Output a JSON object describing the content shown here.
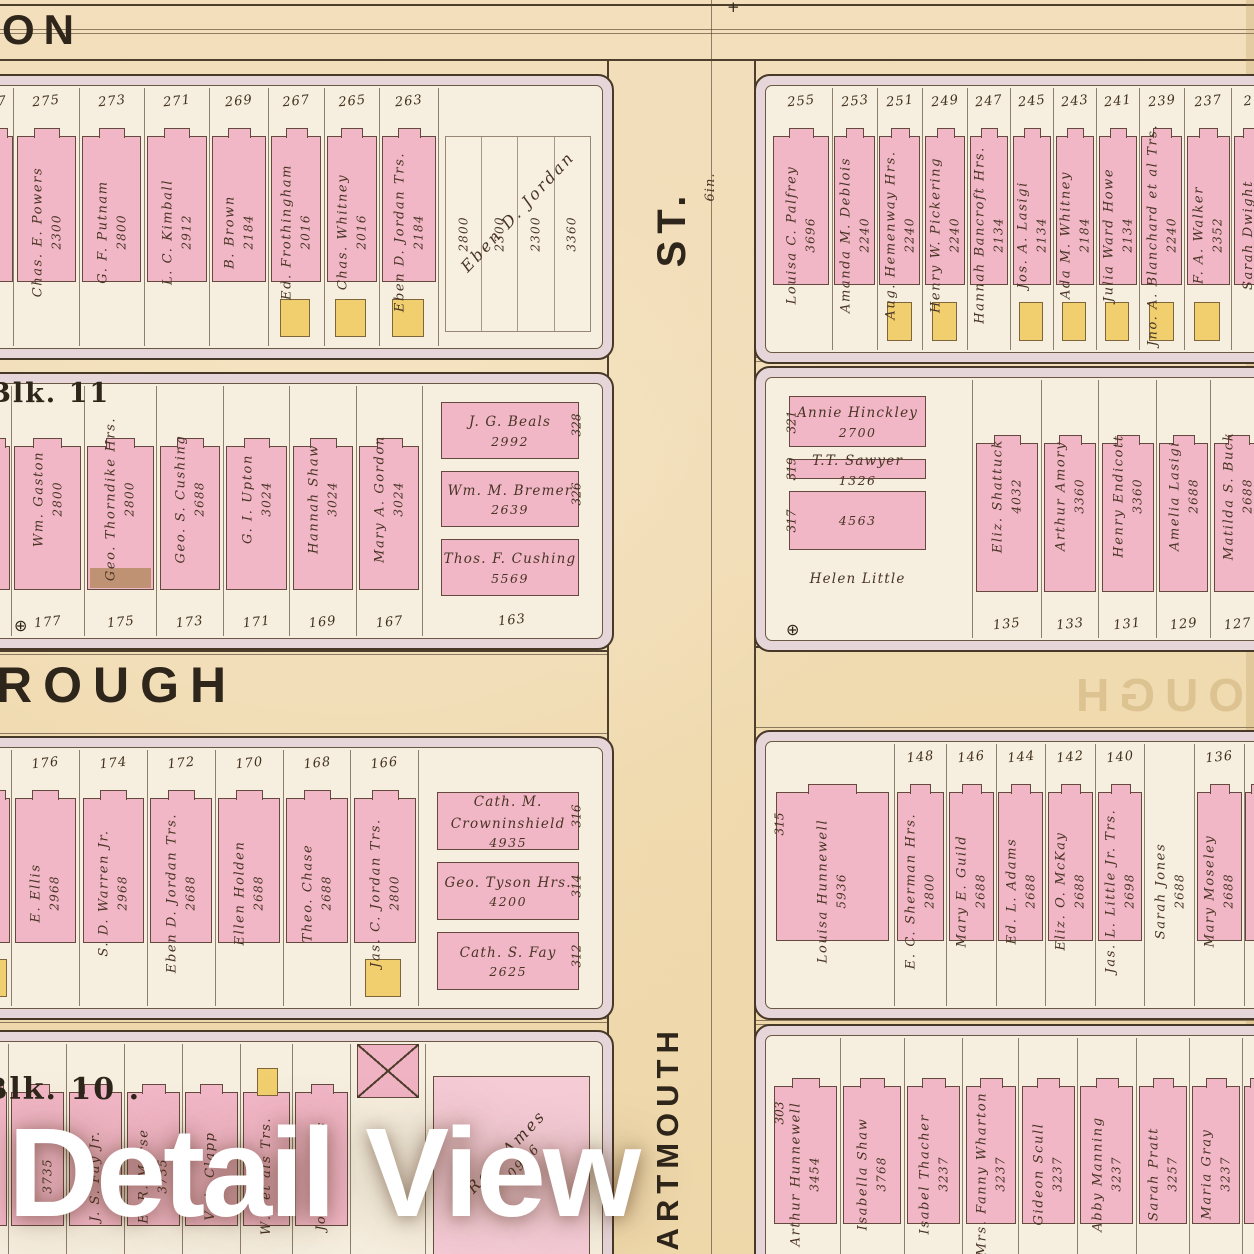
{
  "watermark": "Detail View",
  "labels": {
    "top_street": "ON",
    "cross_street_top": "ST.",
    "pipe_note": "6in.",
    "mid_street": "ROUGH",
    "mid_street_ghost": "ROUGH",
    "cross_street_bottom": "DARTMOUTH",
    "blk11": "Blk. 11",
    "blk10": "Blk. 10 .",
    "benchmark_symbol": "⊕",
    "survey_mark": "+"
  },
  "colors": {
    "paper": "#f3dfbc",
    "block_band": "#e6d6d9",
    "block_interior": "#f6eede",
    "building_pink": "#f2b7c6",
    "building_pale_pink": "#f5ccd6",
    "wood_yellow": "#f1cf6e",
    "stable_brown": "#b98e6a",
    "line_ink": "#4e3e2c",
    "text_ink": "#4a3728"
  },
  "blocks": {
    "row1_left": {
      "street": "top",
      "lots": [
        {
          "no": "7",
          "w": 0.35,
          "fill": "pink",
          "cut": true
        },
        {
          "no": "275",
          "name": "Chas. E. Powers",
          "area": "2300",
          "fill": "pink",
          "w": 1
        },
        {
          "no": "273",
          "name": "G. F. Putnam",
          "area": "2800",
          "fill": "pink",
          "w": 1
        },
        {
          "no": "271",
          "name": "L. C. Kimball",
          "area": "2912",
          "fill": "pink",
          "w": 1
        },
        {
          "no": "269",
          "name": "B. Brown",
          "area": "2184",
          "fill": "pink",
          "w": 0.9
        },
        {
          "no": "267",
          "name": "Ed. Frothingham",
          "area": "2016",
          "fill": "pink",
          "w": 0.85,
          "rear": "yellow"
        },
        {
          "no": "265",
          "name": "Chas. Whitney",
          "area": "2016",
          "fill": "pink",
          "w": 0.85,
          "rear": "yellow"
        },
        {
          "no": "263",
          "name": "Eben D. Jordan Trs.",
          "area": "2184",
          "fill": "pink",
          "w": 0.9,
          "rear": "yellow"
        }
      ],
      "corner": {
        "type": "diagonal",
        "name": "Eben D. Jordan",
        "values": [
          "2800",
          "2300",
          "2300",
          "3360"
        ],
        "w": 2.4
      }
    },
    "row1_right": {
      "street": "top",
      "lots": [
        {
          "no": "255",
          "name": "Louisa C. Palfrey",
          "area": "3696",
          "fill": "pink",
          "w": 1.3
        },
        {
          "no": "253",
          "name": "Amanda M. Deblois",
          "area": "2240",
          "fill": "pink",
          "w": 0.95
        },
        {
          "no": "251",
          "name": "Aug. Hemenway Hrs.",
          "area": "2240",
          "fill": "pink",
          "w": 0.95,
          "rear": "yellow"
        },
        {
          "no": "249",
          "name": "Henry W. Pickering",
          "area": "2240",
          "fill": "pink",
          "w": 0.95,
          "rear": "yellow"
        },
        {
          "no": "247",
          "name": "Hannah Bancroft Hrs.",
          "area": "2134",
          "fill": "pink",
          "w": 0.9
        },
        {
          "no": "245",
          "name": "Jos. A. Lasigi",
          "area": "2134",
          "fill": "pink",
          "w": 0.9,
          "rear": "yellow"
        },
        {
          "no": "243",
          "name": "Ada M. Whitney",
          "area": "2184",
          "fill": "pink",
          "w": 0.9,
          "rear": "yellow"
        },
        {
          "no": "241",
          "name": "Julia Ward Howe",
          "area": "2134",
          "fill": "pink",
          "w": 0.9,
          "rear": "yellow"
        },
        {
          "no": "239",
          "name": "Jno. A. Blanchard et al Trs.",
          "area": "2240",
          "fill": "pink",
          "w": 0.95,
          "rear": "yellow"
        },
        {
          "no": "237",
          "name": "F. A. Walker",
          "area": "2352",
          "fill": "pink",
          "w": 1,
          "rear": "yellow"
        },
        {
          "no": "2",
          "name": "Sarah Dwight",
          "fill": "pink",
          "w": 0.7,
          "cut": true
        }
      ]
    },
    "row2_left": {
      "street": "bottom",
      "lots": [
        {
          "w": 0.3,
          "fill": "pink",
          "cut": true
        },
        {
          "no": "177",
          "name": "Wm. Gaston",
          "area": "2800",
          "fill": "pink",
          "w": 1.1
        },
        {
          "no": "175",
          "name": "Geo. Thorndike Hrs.",
          "area": "2800",
          "fill": "pink",
          "w": 1.1,
          "rear": "brown"
        },
        {
          "no": "173",
          "name": "Geo. S. Cushing",
          "area": "2688",
          "fill": "pink",
          "w": 1
        },
        {
          "no": "171",
          "name": "G. I. Upton",
          "area": "3024",
          "fill": "pink",
          "w": 1
        },
        {
          "no": "169",
          "name": "Hannah Shaw",
          "area": "3024",
          "fill": "pink",
          "w": 1
        },
        {
          "no": "167",
          "name": "Mary A. Gordon",
          "area": "3024",
          "fill": "pink",
          "w": 1
        }
      ],
      "corner": {
        "type": "stack",
        "no": "163",
        "w": 2.6,
        "items": [
          {
            "name": "J. G. Beals",
            "area": "2992",
            "side_no": "328"
          },
          {
            "name": "Wm. M. Bremer",
            "area": "2639",
            "side_no": "326"
          },
          {
            "name": "Thos. F. Cushing",
            "area": "5569"
          }
        ]
      }
    },
    "row2_right": {
      "street": "bottom",
      "left_column": {
        "w": 3.0,
        "items": [
          {
            "name": "Annie Hinckley",
            "area": "2700",
            "h": 1.5,
            "side_no": "321"
          },
          {
            "name": "T.T. Sawyer",
            "area": "1326",
            "h": 0.7,
            "side_no": "319"
          },
          {
            "area": "4563",
            "h": 1.7,
            "side_no": "317"
          },
          {
            "name": "Helen Little",
            "h": 1.1,
            "fill": "none"
          }
        ]
      },
      "lots": [
        {
          "w": 0.5,
          "fill": "none"
        },
        {
          "no": "135",
          "name": "Eliz. Shattuck",
          "area": "4032",
          "fill": "pink",
          "w": 1.2
        },
        {
          "no": "133",
          "name": "Arthur Amory",
          "area": "3360",
          "fill": "pink",
          "w": 1
        },
        {
          "no": "131",
          "name": "Henry Endicott",
          "area": "3360",
          "fill": "pink",
          "w": 1
        },
        {
          "no": "129",
          "name": "Amelia Lasigi",
          "area": "2688",
          "fill": "pink",
          "w": 0.95
        },
        {
          "no": "127",
          "name": "Matilda S. Buck",
          "area": "2688",
          "fill": "pink",
          "w": 0.95
        }
      ]
    },
    "row3_left": {
      "street": "top",
      "lots": [
        {
          "w": 0.3,
          "fill": "pink",
          "cut": true,
          "rear": "yellow"
        },
        {
          "no": "176",
          "name": "E. Ellis",
          "area": "2968",
          "fill": "pink",
          "w": 1
        },
        {
          "no": "174",
          "name": "S. D. Warren Jr.",
          "area": "2968",
          "fill": "pink",
          "w": 1
        },
        {
          "no": "172",
          "name": "Eben D. Jordan Trs.",
          "area": "2688",
          "fill": "pink",
          "w": 1
        },
        {
          "no": "170",
          "name": "Ellen Holden",
          "area": "2688",
          "fill": "pink",
          "w": 1
        },
        {
          "no": "168",
          "name": "Theo. Chase",
          "area": "2688",
          "fill": "pink",
          "w": 1
        },
        {
          "no": "166",
          "name": "Jas. C. Jordan Trs.",
          "area": "2800",
          "fill": "pink",
          "w": 1,
          "rear": "yellow"
        }
      ],
      "corner": {
        "type": "stack",
        "w": 2.6,
        "items": [
          {
            "name": "Cath. M. Crowninshield",
            "area": "4935",
            "side_no": "316"
          },
          {
            "name": "Geo. Tyson Hrs.",
            "area": "4200",
            "side_no": "314"
          },
          {
            "name": "Cath. S. Fay",
            "area": "2625",
            "side_no": "312"
          }
        ]
      }
    },
    "row3_right": {
      "street": "top",
      "lots": [
        {
          "name": "Louisa Hunnewell",
          "area": "5936",
          "fill": "pink",
          "w": 2.4,
          "side_no": "315"
        },
        {
          "no": "148",
          "name": "E. C. Sherman Hrs.",
          "area": "2800",
          "fill": "pink",
          "w": 1
        },
        {
          "no": "146",
          "name": "Mary E. Guild",
          "area": "2688",
          "fill": "pink",
          "w": 0.95
        },
        {
          "no": "144",
          "name": "Ed. L. Adams",
          "area": "2688",
          "fill": "pink",
          "w": 0.95
        },
        {
          "no": "142",
          "name": "Eliz. O. McKay",
          "area": "2688",
          "fill": "pink",
          "w": 0.95
        },
        {
          "no": "140",
          "name": "Jas. L. Little Jr. Trs.",
          "area": "2698",
          "fill": "pink",
          "w": 0.95
        },
        {
          "name": "Sarah Jones",
          "area": "2688",
          "fill": "none",
          "w": 0.95
        },
        {
          "no": "136",
          "name": "Mary Moseley",
          "area": "2688",
          "fill": "pink",
          "w": 0.95
        },
        {
          "w": 0.4,
          "fill": "pink",
          "cut": true
        }
      ]
    },
    "row4_left": {
      "street": "top",
      "lots": [
        {
          "w": 0.3,
          "fill": "pink",
          "cut": true
        },
        {
          "name": "… Howe",
          "area": "3735",
          "fill": "pink",
          "w": 1
        },
        {
          "name": "J. S. Fay Jr.",
          "area": "",
          "fill": "pink",
          "w": 1
        },
        {
          "name": "E. R. Morse",
          "area": "3735",
          "fill": "pink",
          "w": 1
        },
        {
          "name": "V. A. Clapp",
          "area": "",
          "fill": "pink",
          "w": 1
        },
        {
          "name": "W… et als Trs.",
          "area": "",
          "fill": "pink",
          "w": 0.9,
          "front": "yellow"
        },
        {
          "name": "John D. Bates",
          "area": "",
          "fill": "pink",
          "w": 1
        },
        {
          "fill": "xbox",
          "w": 1.3
        },
        {
          "type": "diagonal",
          "name": "Re… Ames",
          "area": "10956",
          "fill": "palepink",
          "w": 3.0
        }
      ]
    },
    "row4_right": {
      "street": "top",
      "lots": [
        {
          "name": "Arthur Hunnewell",
          "area": "3454",
          "fill": "pink",
          "w": 1.25,
          "side_no": "303"
        },
        {
          "name": "Isabella Shaw",
          "area": "3768",
          "fill": "pink",
          "w": 1.15
        },
        {
          "name": "Isabel Thacher",
          "area": "3237",
          "fill": "pink",
          "w": 1.05
        },
        {
          "name": "Mrs. Fanny Wharton",
          "area": "3237",
          "fill": "pink",
          "w": 1
        },
        {
          "name": "Gideon Scull",
          "area": "3237",
          "fill": "pink",
          "w": 1.05
        },
        {
          "name": "Abby Manning",
          "area": "3237",
          "fill": "pink",
          "w": 1.05
        },
        {
          "name": "Sarah Pratt",
          "area": "3257",
          "fill": "pink",
          "w": 0.95
        },
        {
          "name": "Maria Gray",
          "area": "3237",
          "fill": "pink",
          "w": 0.95
        },
        {
          "w": 0.4,
          "fill": "pink",
          "cut": true
        }
      ]
    }
  }
}
